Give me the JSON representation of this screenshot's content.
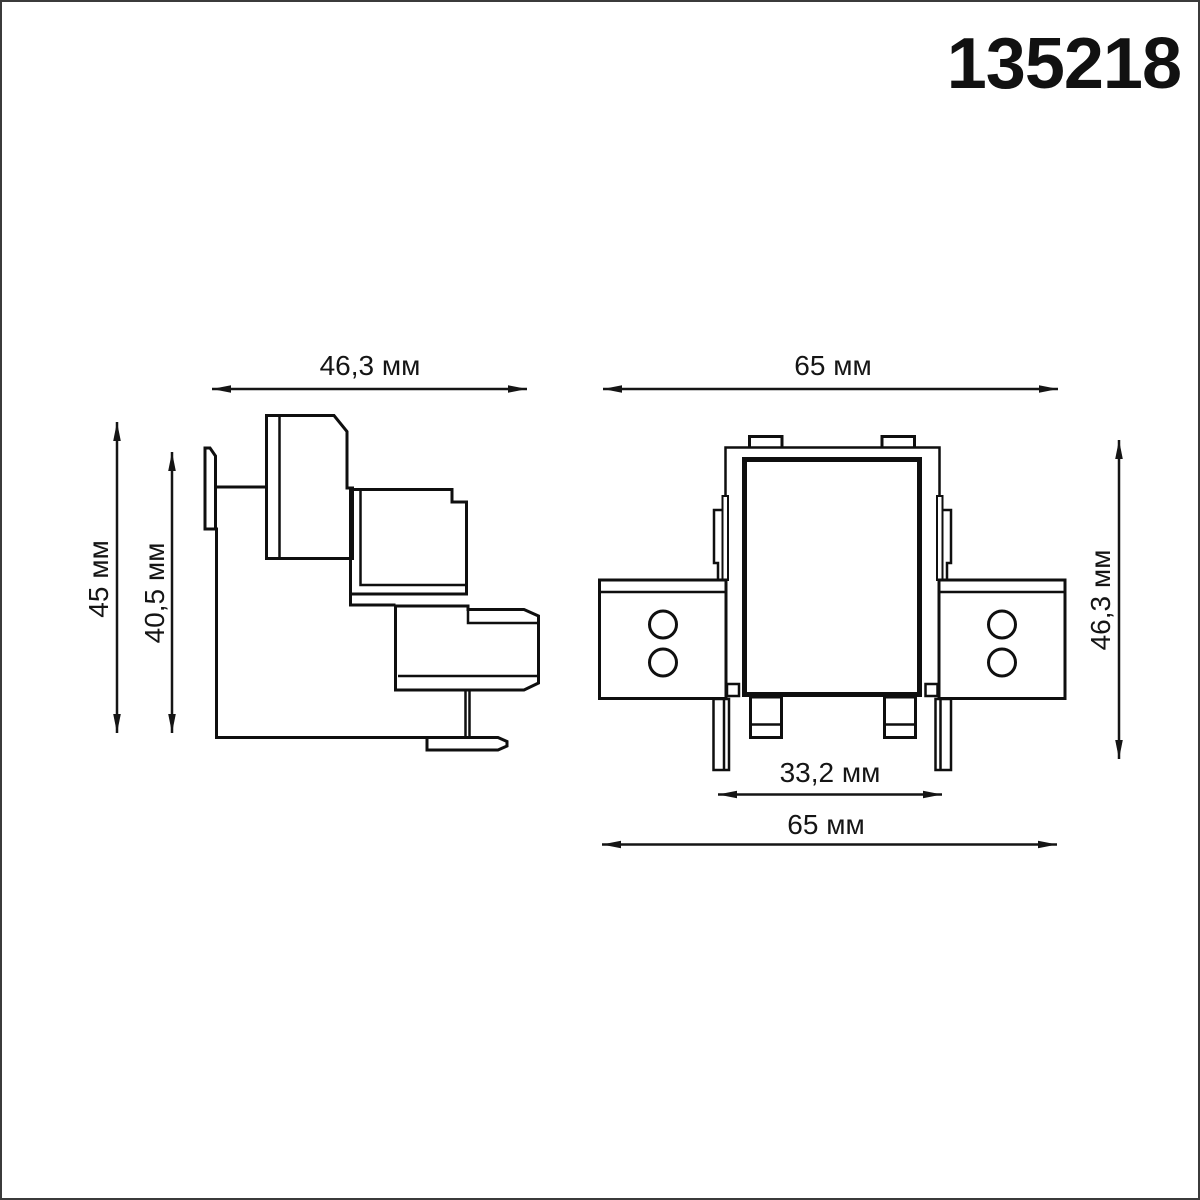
{
  "page": {
    "background_color": "#ffffff",
    "border_color": "#3b3b3b",
    "line_color": "#0f0f0f"
  },
  "header": {
    "product_code": "135218"
  },
  "side_view": {
    "width_label": "46,3 мм",
    "outer_height_label": "45 мм",
    "inner_height_label": "40,5 мм"
  },
  "front_view": {
    "top_width_label": "65 мм",
    "height_label": "46,3 мм",
    "inner_width_label": "33,2 мм",
    "bottom_width_label": "65 мм"
  }
}
